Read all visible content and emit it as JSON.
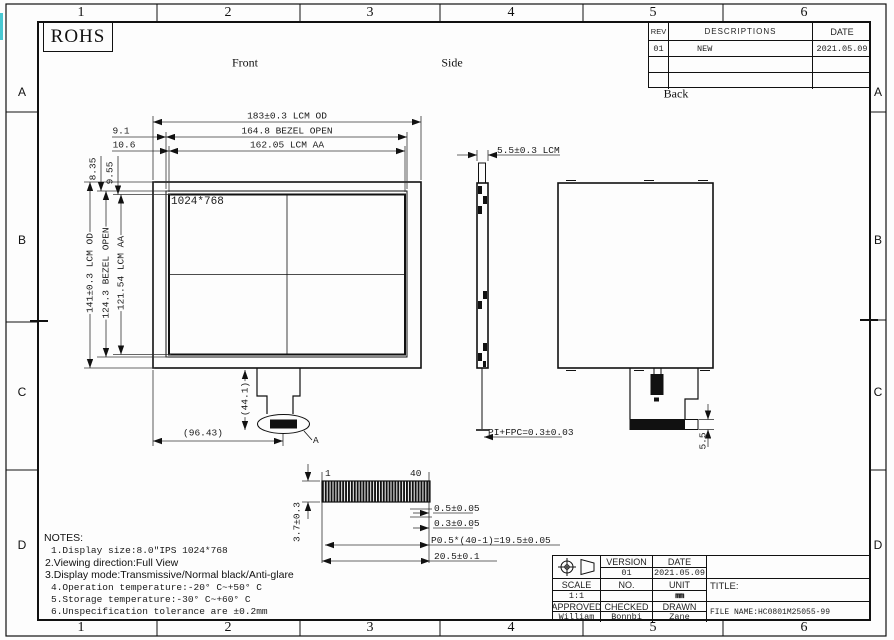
{
  "sheet": {
    "cols": [
      "1",
      "2",
      "3",
      "4",
      "5",
      "6"
    ],
    "rows": [
      "A",
      "B",
      "C",
      "D"
    ],
    "rohs": "ROHS"
  },
  "labels": {
    "front": "Front",
    "side": "Side",
    "back": "Back"
  },
  "rev": {
    "h": [
      "REV",
      "DESCRIPTIONS",
      "DATE"
    ],
    "rows": [
      {
        "rev": "01",
        "desc": "NEW",
        "date": "2021.05.09"
      },
      {
        "rev": "",
        "desc": "",
        "date": ""
      },
      {
        "rev": "",
        "desc": "",
        "date": ""
      }
    ]
  },
  "front": {
    "res": "1024*768",
    "w_od": "183±0.3 LCM OD",
    "w_bezel": "164.8 BEZEL OPEN",
    "w_aa": "162.05 LCM AA",
    "x_bezel": "9.1",
    "x_aa": "10.6",
    "y_bezel": "8.35",
    "y_aa": "9.55",
    "h_od": "141±0.3 LCM OD",
    "h_bezel": "124.3 BEZEL OPEN",
    "h_aa": "121.54 LCM AA",
    "tail_len": "(44.1)",
    "tail_pos": "(96.43)",
    "detail_label": "A"
  },
  "side": {
    "thickness": "5.5±0.3 LCM",
    "pi_fpc": "PI+FPC=0.3±0.03"
  },
  "back": {
    "tail_h": "5.5"
  },
  "fpc": {
    "pin1": "1",
    "pin40": "40",
    "height": "3.7±0.3",
    "t1": "0.5±0.05",
    "t2": "0.3±0.05",
    "pitch": "P0.5*(40-1)=19.5±0.05",
    "width": "20.5±0.1"
  },
  "notes": {
    "title": "NOTES:",
    "items": [
      "1.Display size:8.0″IPS 1024*768",
      "2.Viewing direction:Full View",
      "3.Display mode:Transmissive/Normal black/Anti-glare",
      "4.Operation temperature:-20° C~+50° C",
      "5.Storage temperature:-30° C~+60° C",
      "6.Unspecification tolerance are ±0.2mm"
    ]
  },
  "tb": {
    "version_h": "VERSION",
    "date_h": "DATE",
    "version": "01",
    "date": "2021.05.09",
    "scale_h": "SCALE",
    "no_h": "NO.",
    "unit_h": "UNIT",
    "scale": "1:1",
    "no": "",
    "unit": "mm",
    "approved_h": "APPROVED",
    "checked_h": "CHECKED",
    "drawn_h": "DRAWN",
    "approved": "William",
    "checked": "Bonnbi",
    "drawn": "Zane",
    "title_h": "TITLE:",
    "file": "FILE NAME:HC0801M25055-99"
  }
}
